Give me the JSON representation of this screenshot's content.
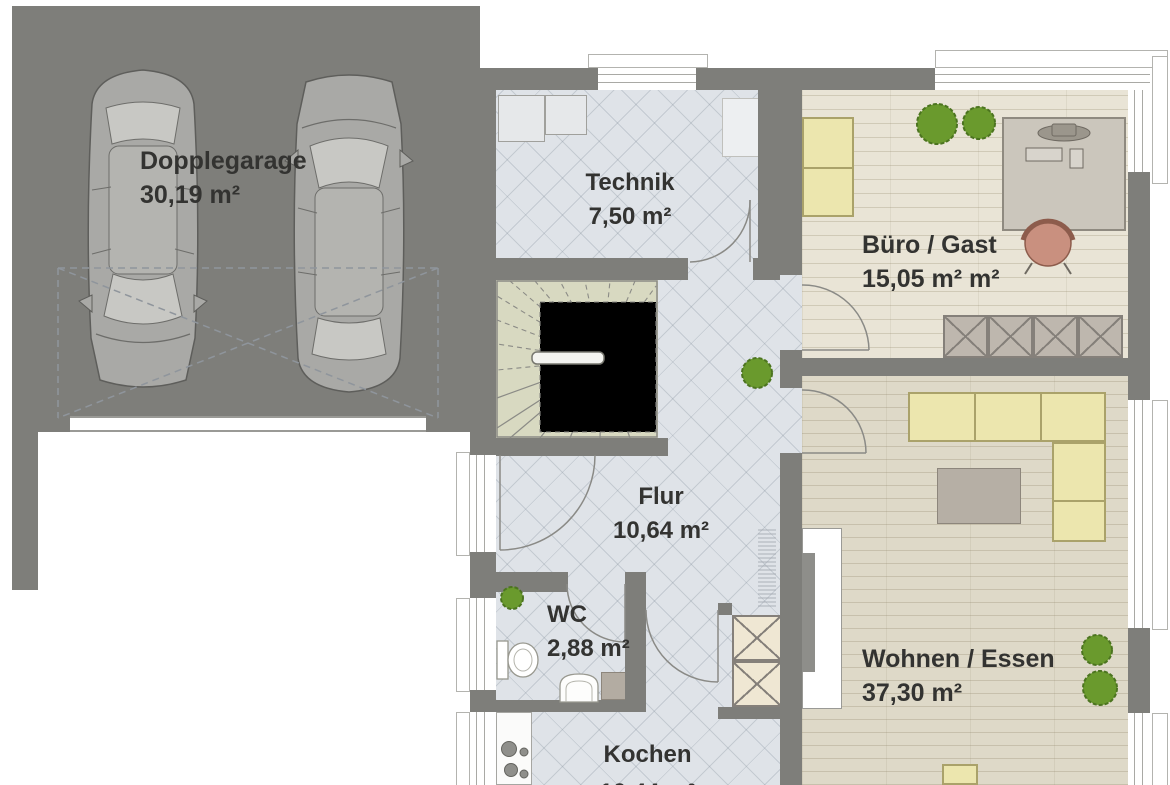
{
  "floorplan": {
    "title": "Erdgeschoss Grundriss",
    "rooms": [
      {
        "id": "garage",
        "name": "Dopplegarage",
        "area": "30,19 m²"
      },
      {
        "id": "technik",
        "name": "Technik",
        "area": "7,50 m²"
      },
      {
        "id": "buero",
        "name": "Büro / Gast",
        "area": "15,05 m² m²"
      },
      {
        "id": "flur",
        "name": "Flur",
        "area": "10,64 m²"
      },
      {
        "id": "wc",
        "name": "WC",
        "area": "2,88 m²"
      },
      {
        "id": "wohnen",
        "name": "Wohnen / Essen",
        "area": "37,30 m²"
      },
      {
        "id": "kochen",
        "name": "Kochen",
        "area": "10,44 m²"
      }
    ],
    "colors": {
      "wall": "#7e7e7a",
      "garage_floor": "#c9d0d7",
      "tile_floor": "#dfe3e8",
      "wood_office": "#e9e4d6",
      "wood_living": "#ded9c8",
      "stair": "#d8d9c1",
      "sofa": "#ece6ae",
      "plant": "#6a9a2d",
      "desk_chair": "#c9907f",
      "sideboard": "#beb7ae",
      "wardrobe": "#efe7d3"
    }
  }
}
